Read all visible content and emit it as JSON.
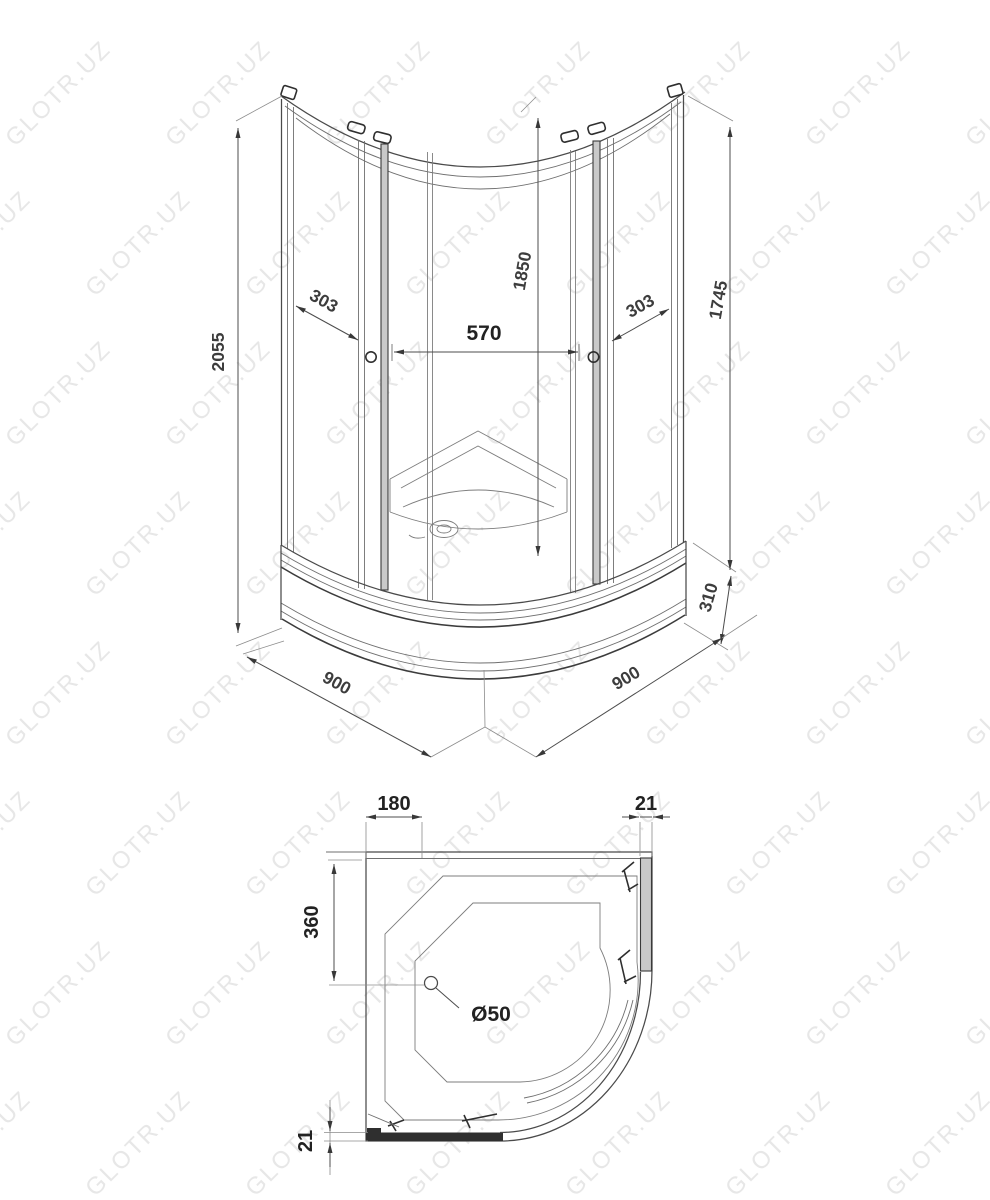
{
  "watermark": {
    "text": "GLOTR.UZ",
    "color": "#e7e7e7"
  },
  "drawing": {
    "line_color": "#4a4a4a",
    "dim_text_color": "#222222",
    "front": {
      "dims": {
        "total_height": "2055",
        "inner_height": "1850",
        "glass_height": "1745",
        "left_panel_width": "303",
        "door_opening_width": "570",
        "right_panel_width": "303",
        "tray_height": "310",
        "base_width": "900",
        "base_depth": "900"
      }
    },
    "plan": {
      "dims": {
        "wall_to_seat": "180",
        "profile_thickness_top": "21",
        "drain_offset": "360",
        "drain_diameter": "Ø50",
        "profile_thickness_bottom": "21"
      }
    }
  }
}
